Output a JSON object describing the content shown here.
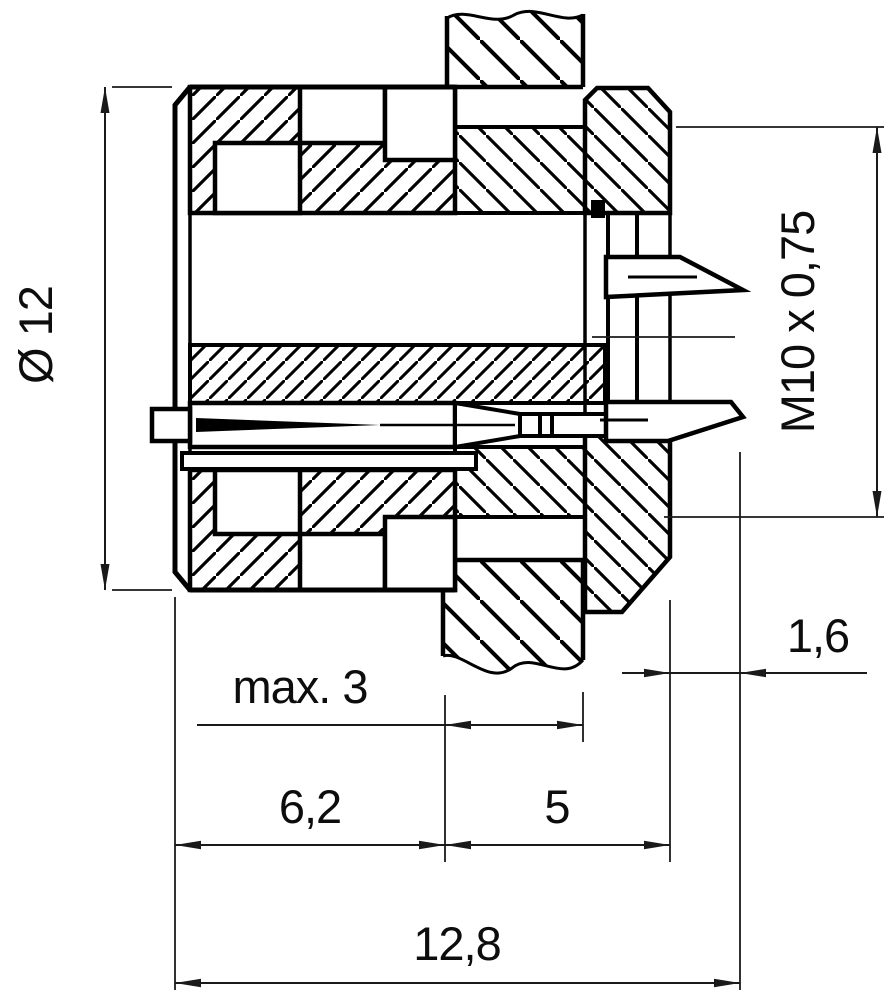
{
  "drawing": {
    "type": "dimensioned cross-section of panel-mount circular connector",
    "colors": {
      "ink": "#000000",
      "dimension_lines": "#1a1a1a",
      "background": "#ffffff"
    },
    "dimensions": {
      "diameter": {
        "label": "Ø 12",
        "value": 12,
        "orientation": "vertical-left"
      },
      "thread": {
        "label": "M10 x 0,75",
        "value": "M10 x 0,75",
        "orientation": "vertical-right"
      },
      "panel_thickness": {
        "label": "max. 3",
        "value": 3,
        "orientation": "horizontal"
      },
      "front_length": {
        "label": "6,2",
        "value": 6.2,
        "orientation": "horizontal"
      },
      "mid_length": {
        "label": "5",
        "value": 5,
        "orientation": "horizontal"
      },
      "rear_offset": {
        "label": "1,6",
        "value": 1.6,
        "orientation": "horizontal"
      },
      "total_length": {
        "label": "12,8",
        "value": 12.8,
        "orientation": "horizontal"
      }
    }
  }
}
